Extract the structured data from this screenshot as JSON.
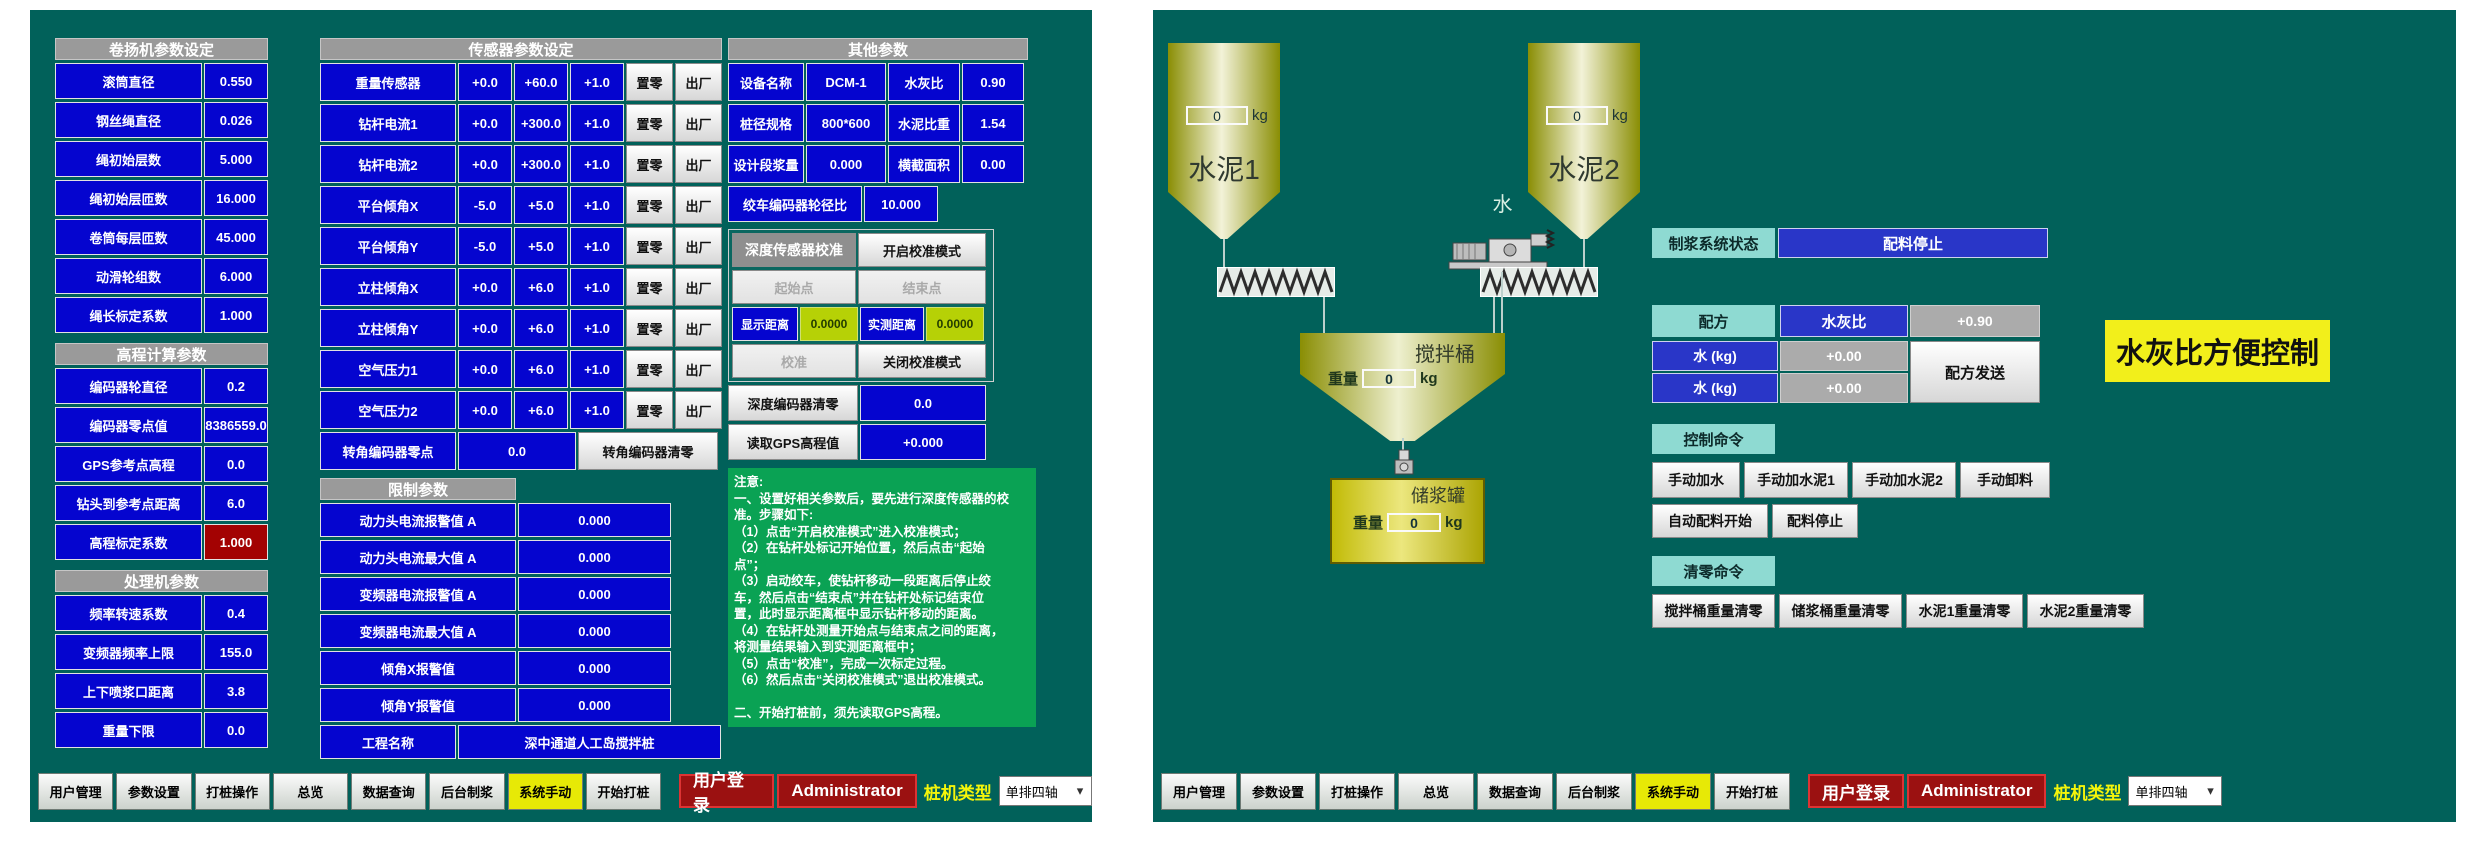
{
  "colors": {
    "panel_teal": "#01615a",
    "cell_blue": "#0505cf",
    "section_gray": "#9a9a9a",
    "alarm_red": "#a30202",
    "calib_green_value": "#b6d106",
    "notes_green": "#0aa254",
    "nav_active_yellow": "#e7e906",
    "login_red": "#9b1111",
    "label_cyan": "#8edad2",
    "status_blue": "#2936c8",
    "tank_olive": "#8a8e04",
    "highlight_yellow": "#f2ef1b"
  },
  "left_panel": {
    "sections_col1": [
      {
        "title": "卷扬机参数设定",
        "rows": [
          [
            "滚筒直径",
            "0.550"
          ],
          [
            "钢丝绳直径",
            "0.026"
          ],
          [
            "绳初始层数",
            "5.000"
          ],
          [
            "绳初始层匝数",
            "16.000"
          ],
          [
            "卷筒每层匝数",
            "45.000"
          ],
          [
            "动滑轮组数",
            "6.000"
          ],
          [
            "绳长标定系数",
            "1.000"
          ]
        ]
      },
      {
        "title": "高程计算参数",
        "rows": [
          [
            "编码器轮直径",
            "0.2"
          ],
          [
            "编码器零点值",
            "8386559.0"
          ],
          [
            "GPS参考点高程",
            "0.0"
          ],
          [
            "钻头到参考点距离",
            "6.0"
          ],
          [
            "高程标定系数",
            "1.000"
          ]
        ],
        "red_row": 4
      },
      {
        "title": "处理机参数",
        "rows": [
          [
            "频率转速系数",
            "0.4"
          ],
          [
            "变频器频率上限",
            "155.0"
          ],
          [
            "上下喷浆口距离",
            "3.8"
          ],
          [
            "重量下限",
            "0.0"
          ]
        ]
      }
    ],
    "sensor_section": {
      "title": "传感器参数设定",
      "zero_button": "置零",
      "factory_button": "出厂",
      "rows": [
        [
          "重量传感器",
          "+0.0",
          "+60.0",
          "+1.0"
        ],
        [
          "钻杆电流1",
          "+0.0",
          "+300.0",
          "+1.0"
        ],
        [
          "钻杆电流2",
          "+0.0",
          "+300.0",
          "+1.0"
        ],
        [
          "平台倾角X",
          "-5.0",
          "+5.0",
          "+1.0"
        ],
        [
          "平台倾角Y",
          "-5.0",
          "+5.0",
          "+1.0"
        ],
        [
          "立柱倾角X",
          "+0.0",
          "+6.0",
          "+1.0"
        ],
        [
          "立柱倾角Y",
          "+0.0",
          "+6.0",
          "+1.0"
        ],
        [
          "空气压力1",
          "+0.0",
          "+6.0",
          "+1.0"
        ],
        [
          "空气压力2",
          "+0.0",
          "+6.0",
          "+1.0"
        ]
      ],
      "encoder_zero_label": "转角编码器零点",
      "encoder_zero_value": "0.0",
      "encoder_clear_button": "转角编码器清零"
    },
    "limit_section": {
      "title": "限制参数",
      "rows": [
        [
          "动力头电流报警值 A",
          "0.000"
        ],
        [
          "动力头电流最大值 A",
          "0.000"
        ],
        [
          "变频器电流报警值 A",
          "0.000"
        ],
        [
          "变频器电流最大值 A",
          "0.000"
        ],
        [
          "倾角X报警值",
          "0.000"
        ],
        [
          "倾角Y报警值",
          "0.000"
        ]
      ],
      "project_label": "工程名称",
      "project_value": "深中通道人工岛搅拌桩"
    },
    "other_section": {
      "title": "其他参数",
      "rows": [
        [
          [
            "设备名称",
            "DCM-1"
          ],
          [
            "水灰比",
            "0.90"
          ]
        ],
        [
          [
            "桩径规格",
            "800*600"
          ],
          [
            "水泥比重",
            "1.54"
          ]
        ],
        [
          [
            "设计段浆量",
            "0.000"
          ],
          [
            "横截面积",
            "0.00"
          ]
        ]
      ],
      "winch_ratio_label": "绞车编码器轮径比",
      "winch_ratio_value": "10.000"
    },
    "calibration": {
      "header": "深度传感器校准",
      "open_mode_button": "开启校准模式",
      "start_button": "起始点",
      "end_button": "结束点",
      "display_distance_label": "显示距离",
      "display_distance_value": "0.0000",
      "measured_distance_label": "实测距离",
      "measured_distance_value": "0.0000",
      "calibrate_button": "校准",
      "close_mode_button": "关闭校准模式",
      "depth_encoder_clear_button": "深度编码器清零",
      "depth_encoder_value": "0.0",
      "read_gps_button": "读取GPS高程值",
      "gps_value": "+0.000"
    },
    "notes": {
      "lines": [
        "注意:",
        "一、设置好相关参数后，要先进行深度传感器的校",
        "准。步骤如下:",
        "（1）点击“开启校准模式”进入校准模式；",
        "（2）在钻杆处标记开始位置，然后点击“起始",
        "点”；",
        "（3）启动绞车，使钻杆移动一段距离后停止绞",
        "车，然后点击“结束点”并在钻杆处标记结束位",
        "置，此时显示距离框中显示钻杆移动的距离。",
        "（4）在钻杆处测量开始点与结束点之间的距离，",
        "将测量结果输入到实测距离框中；",
        "（5）点击“校准”，完成一次标定过程。",
        "（6）然后点击“关闭校准模式”退出校准模式。",
        "",
        "二、开始打桩前，须先读取GPS高程。"
      ]
    }
  },
  "right_panel": {
    "diagram": {
      "cement1_label": "水泥1",
      "cement1_weight": "0",
      "cement2_label": "水泥2",
      "cement2_weight": "0",
      "kg_unit": "kg",
      "water_label": "水",
      "mixer_label": "搅拌桶",
      "mixer_weight_label": "重量",
      "mixer_weight": "0",
      "tank_label": "储浆罐",
      "tank_weight_label": "重量",
      "tank_weight": "0"
    },
    "status_label": "制浆系统状态",
    "status_value": "配料停止",
    "recipe": {
      "header": "配方",
      "ratio_label": "水灰比",
      "ratio_value": "+0.90",
      "rows": [
        [
          "水 (kg)",
          "+0.00"
        ],
        [
          "水 (kg)",
          "+0.00"
        ]
      ],
      "send_button": "配方发送"
    },
    "control_header": "控制命令",
    "manual_buttons": [
      "手动加水",
      "手动加水泥1",
      "手动加水泥2",
      "手动卸料"
    ],
    "auto_buttons": [
      "自动配料开始",
      "配料停止"
    ],
    "clear_header": "清零命令",
    "clear_buttons": [
      "搅拌桶重量清零",
      "储浆桶重量清零",
      "水泥1重量清零",
      "水泥2重量清零"
    ],
    "side_label": "水灰比方便控制"
  },
  "nav": {
    "buttons": [
      "用户管理",
      "参数设置",
      "打桩操作",
      "总览",
      "数据查询",
      "后台制浆",
      "系统手动",
      "开始打桩"
    ],
    "active_button": "系统手动",
    "login_button": "用户登录",
    "username": "Administrator",
    "pile_type_label": "桩机类型",
    "pile_type_value": "单排四轴",
    "dropdown_chevron": "▾"
  }
}
